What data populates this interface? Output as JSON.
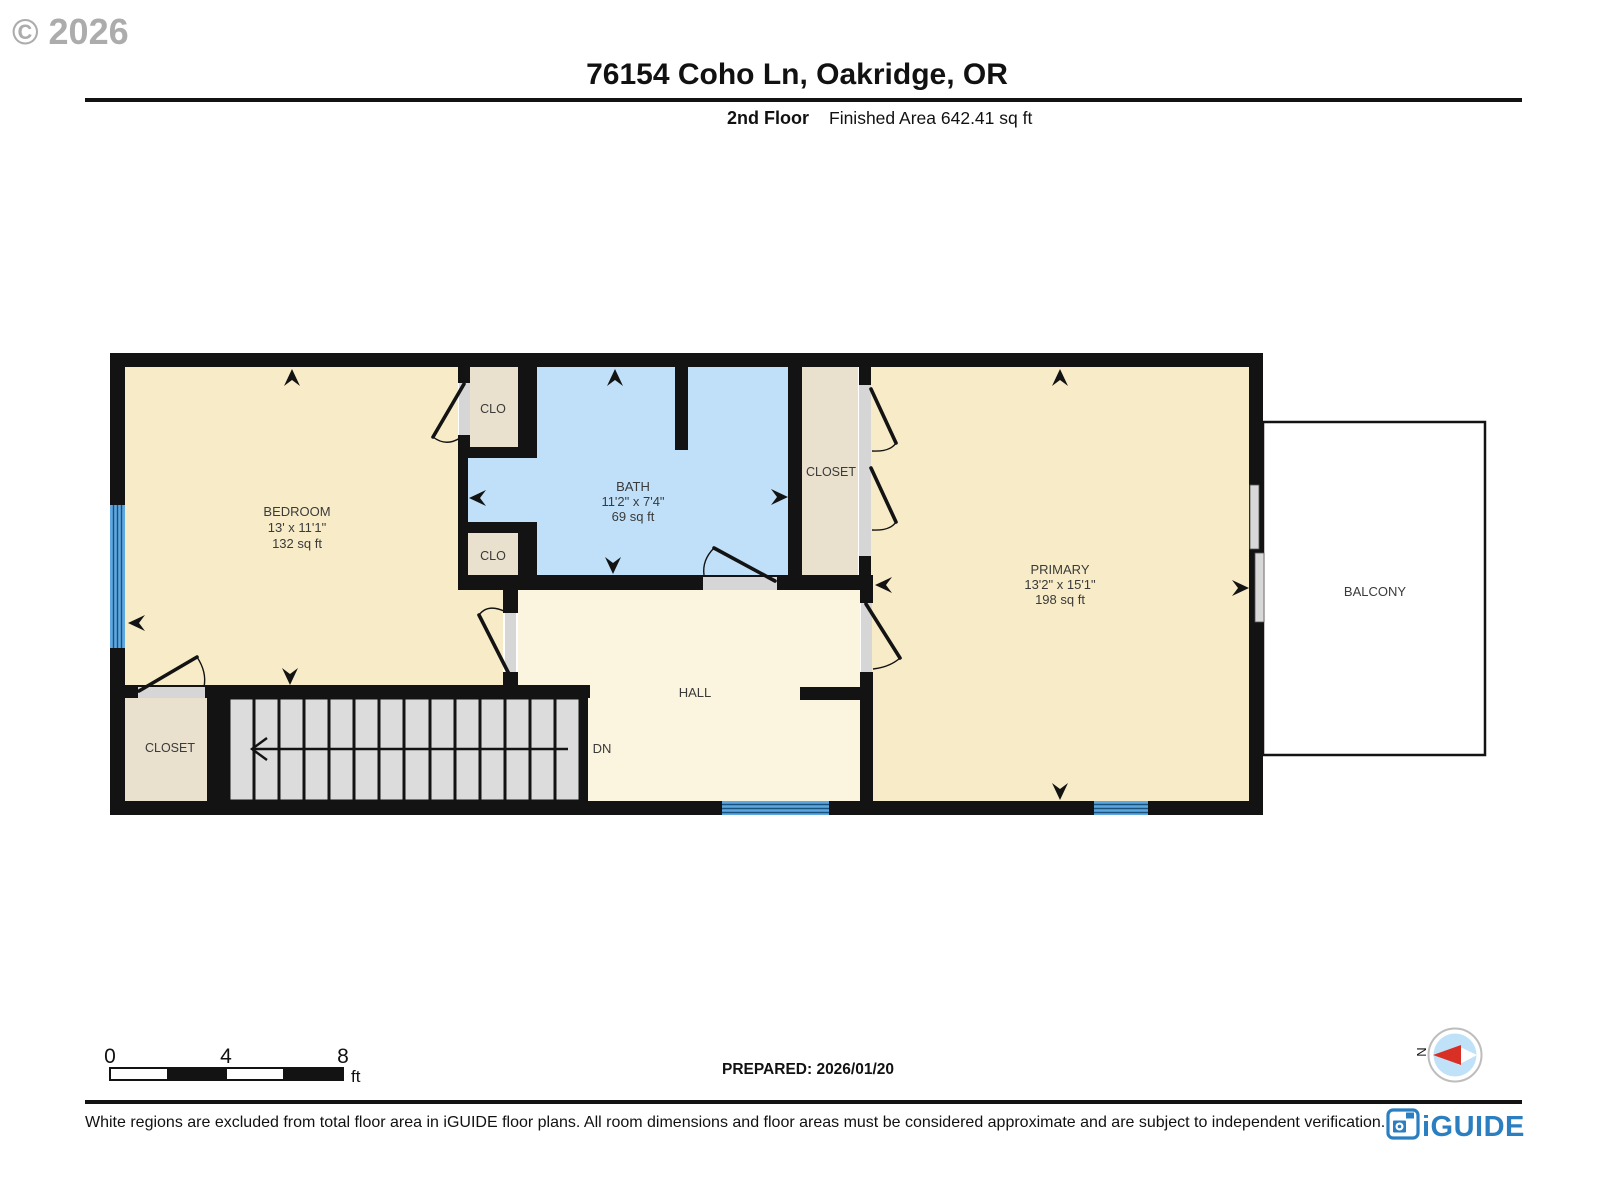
{
  "watermark": "© 2026",
  "header": {
    "title": "76154 Coho Ln, Oakridge, OR",
    "floor_label": "2nd Floor",
    "area_label": "Finished Area 642.41 sq ft"
  },
  "rooms": {
    "bedroom": {
      "name": "BEDROOM",
      "dims": "13' x 11'1\"",
      "area": "132 sq ft"
    },
    "bath": {
      "name": "BATH",
      "dims": "11'2\" x 7'4\"",
      "area": "69 sq ft"
    },
    "primary": {
      "name": "PRIMARY",
      "dims": "13'2\" x 15'1\"",
      "area": "198 sq ft"
    },
    "hall": {
      "name": "HALL"
    },
    "clo_top": {
      "name": "CLO"
    },
    "clo_bottom": {
      "name": "CLO"
    },
    "closet_right": {
      "name": "CLOSET"
    },
    "closet_left": {
      "name": "CLOSET"
    },
    "balcony": {
      "name": "BALCONY"
    }
  },
  "stairs": {
    "dn_label": "DN"
  },
  "scale_bar": {
    "tick0": "0",
    "tick4": "4",
    "tick8": "8",
    "unit": "ft"
  },
  "prepared": "PREPARED: 2026/01/20",
  "compass": {
    "north_label": "N"
  },
  "footer": {
    "disclaimer": "White regions are excluded from total floor area in iGUIDE floor plans. All room dimensions and floor areas must be considered approximate and are subject to independent verification.",
    "logo_text": "iGUIDE"
  },
  "colors": {
    "wall": "#131313",
    "bedroom_fill": "#F8ECC8",
    "hall_fill": "#FBF4DF",
    "bath_fill": "#BFE0F8",
    "closet_fill": "#E9E0CE",
    "stairs_fill": "#DCDCDC",
    "window_blue": "#5FA8DF",
    "window_stripe": "#17527E",
    "door_sill": "#D6D6D6",
    "balcony_fill": "#FFFFFF",
    "logo_blue": "#2B7FC0",
    "compass_blue": "#BFE2F8",
    "compass_red": "#D93025",
    "label_color": "#3A3A3A"
  }
}
